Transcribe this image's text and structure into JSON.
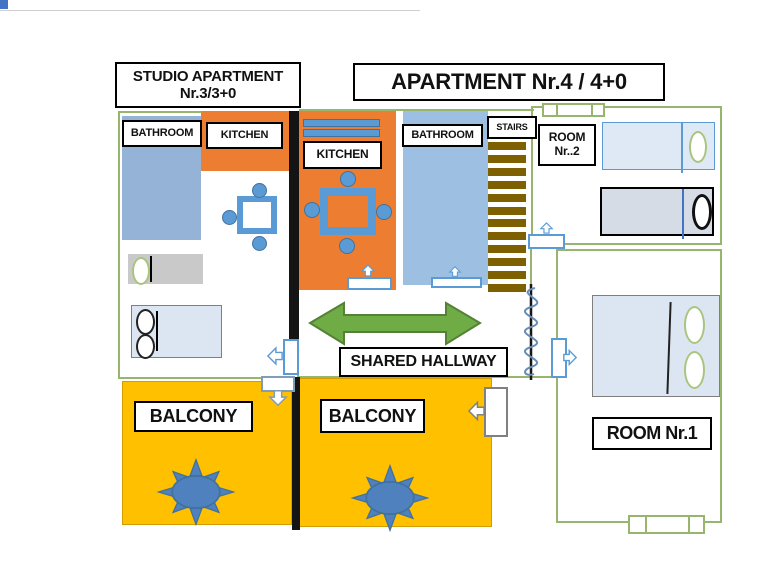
{
  "titles": {
    "studio_line1": "STUDIO APARTMENT",
    "studio_line2": "Nr.3/3+0",
    "apartment4": "APARTMENT Nr.4 / 4+0"
  },
  "rooms": {
    "studio_bathroom": "BATHROOM",
    "studio_kitchen": "KITCHEN",
    "apt4_kitchen": "KITCHEN",
    "apt4_bathroom": "BATHROOM",
    "stairs": "STAIRS",
    "room2_line1": "ROOM",
    "room2_line2": "Nr..2",
    "hallway": "SHARED HALLWAY",
    "balcony_left": "BALCONY",
    "balcony_right": "BALCONY",
    "room1": "ROOM Nr.1"
  },
  "colors": {
    "orange": "#ED7D31",
    "blue_fill": "#95B3D7",
    "blue_fill_light": "#9DC0E2",
    "accent_blue": "#5B9BD5",
    "sun_blue": "#4E81BD",
    "yellow": "#FFC000",
    "green_arrow": "#6FAC46",
    "green_arrow_dark": "#538135",
    "wall_green": "#97B56C",
    "stair_brown": "#7F6000",
    "bed_light": "#DCE6F2",
    "bed_gray": "#D6DCE5",
    "pillow_green": "#A9C47F"
  }
}
